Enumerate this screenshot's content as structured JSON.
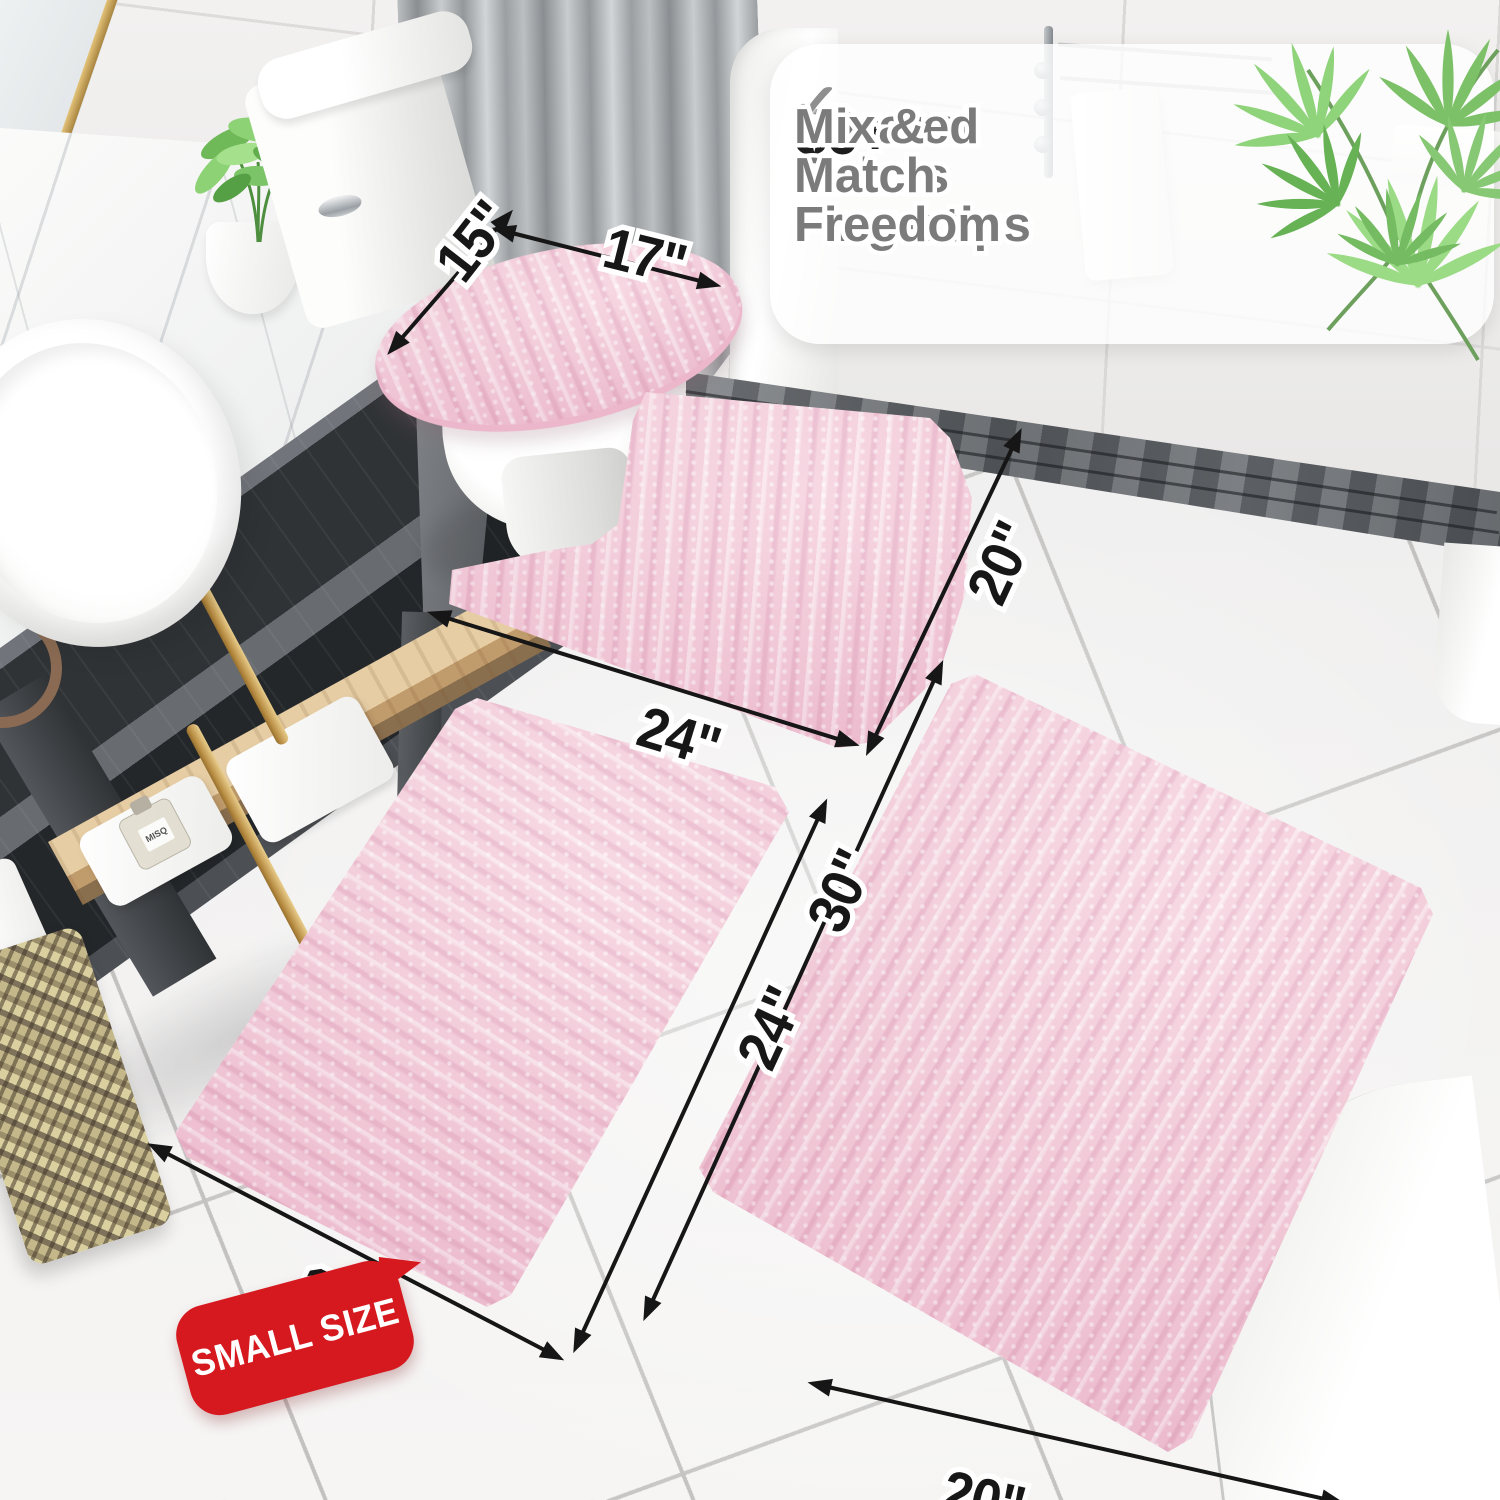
{
  "callout": {
    "check_icon": "✓",
    "items": [
      {
        "prefix": "20+",
        "text": "Sizes at Your Fingertips"
      },
      {
        "prefix": "30+",
        "text": "Curated Colors"
      },
      {
        "prefix": "",
        "text": "Mix & Match Freedom"
      }
    ]
  },
  "dimensions": {
    "lid_depth": "15\"",
    "lid_width": "17\"",
    "contour_width": "24\"",
    "contour_depth": "20\"",
    "small_rug_width": "16\"",
    "small_rug_length": "24\"",
    "large_rug_length": "30\"",
    "large_rug_width": "20\""
  },
  "badge": {
    "label": "SMALL SIZE"
  },
  "vanity": {
    "bottle_label": "MISQ"
  },
  "colors": {
    "rug_pink": "#F3C7D6",
    "badge_red": "#D6191F",
    "arrow_black": "#161616",
    "feature_gray": "#7B7B7B",
    "number_dark": "#1D1D1D"
  }
}
